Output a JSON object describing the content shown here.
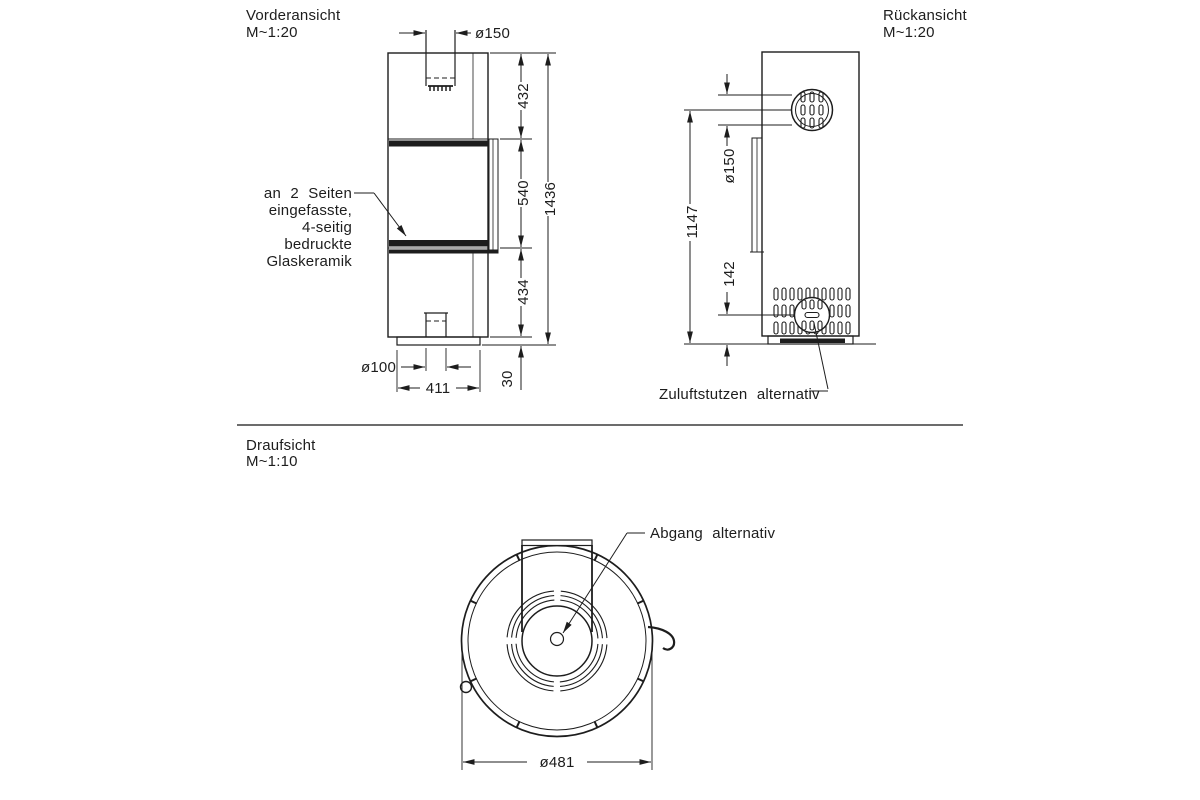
{
  "drawing": {
    "background": "#ffffff",
    "line_color": "#1d1d1d",
    "front": {
      "title": "Vorderansicht",
      "scale": "M~1:20",
      "dims": {
        "flue_d": "ø150",
        "upper": "432",
        "glass": "540",
        "lower": "434",
        "total": "1436",
        "plinth": "30",
        "inlet_d": "ø100",
        "base_w": "411"
      },
      "note": [
        "an 2 Seiten",
        "eingefasste,",
        "4-seitig",
        "bedruckte",
        "Glaskeramik"
      ]
    },
    "rear": {
      "title": "Rückansicht",
      "scale": "M~1:20",
      "dims": {
        "flue_d": "ø150",
        "flue_h": "1147",
        "inlet_h": "142"
      },
      "air_label": "Zuluftstutzen alternativ"
    },
    "top": {
      "title": "Draufsicht",
      "scale": "M~1:10",
      "dims": {
        "outer_d": "ø481"
      },
      "outlet_label": "Abgang alternativ"
    }
  }
}
